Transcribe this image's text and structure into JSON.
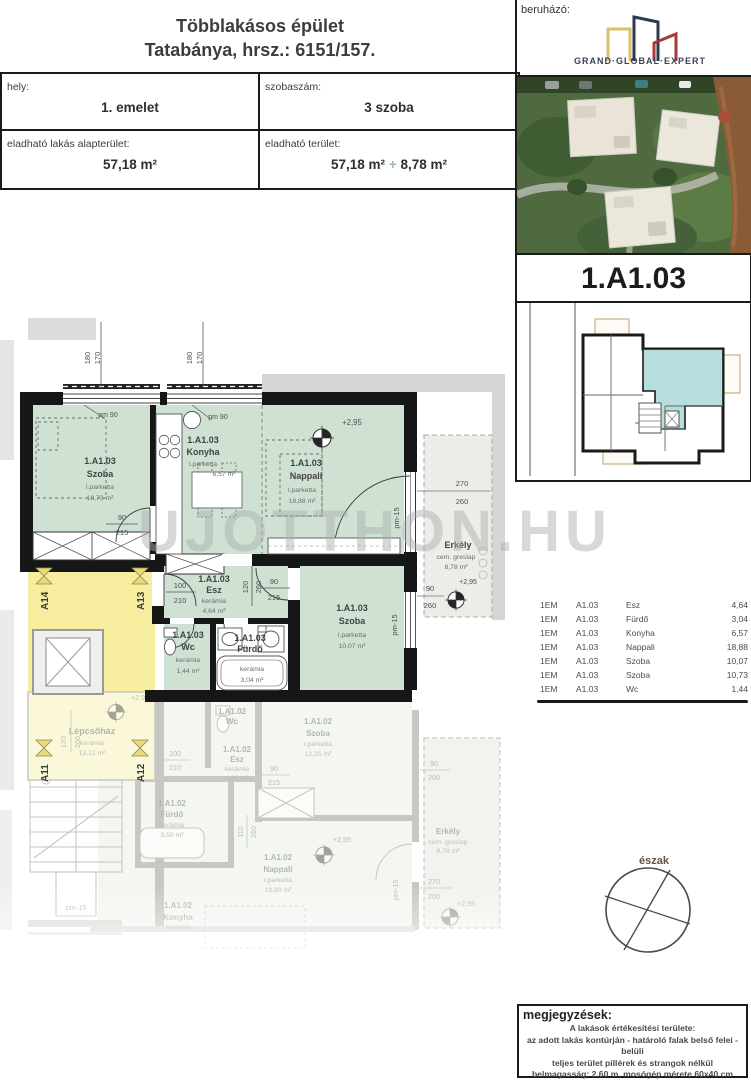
{
  "header": {
    "title1": "Többlakásos épület",
    "title2": "Tatabánya, hrsz.: 6151/157.",
    "hely_label": "hely:",
    "hely_value": "1. emelet",
    "szoba_label": "szobaszám:",
    "szoba_value": "3 szoba",
    "alap_label": "eladható lakás alapterület:",
    "alap_value": "57,18 m²",
    "ter_label": "eladható terület:",
    "ter_value": "57,18 m²",
    "ter_plus": "+",
    "ter_extra": "8,78 m²"
  },
  "developer": {
    "label": "beruházó:",
    "logo": "GRAND·GLOBAL·EXPERT"
  },
  "unit_id": "1.A1.03",
  "watermark": "UJOTTHON.HU",
  "room_table": {
    "rows": [
      {
        "floor": "1EM",
        "unit": "A1.03",
        "room": "Esz",
        "area": "4,64"
      },
      {
        "floor": "1EM",
        "unit": "A1.03",
        "room": "Fürdő",
        "area": "3,04"
      },
      {
        "floor": "1EM",
        "unit": "A1.03",
        "room": "Konyha",
        "area": "6,57"
      },
      {
        "floor": "1EM",
        "unit": "A1.03",
        "room": "Nappali",
        "area": "18,88"
      },
      {
        "floor": "1EM",
        "unit": "A1.03",
        "room": "Szoba",
        "area": "10,07"
      },
      {
        "floor": "1EM",
        "unit": "A1.03",
        "room": "Szoba",
        "area": "10,73"
      },
      {
        "floor": "1EM",
        "unit": "A1.03",
        "room": "Wc",
        "area": "1,44"
      }
    ]
  },
  "north": {
    "label": "észak"
  },
  "notes": {
    "title": "megjegyzések:",
    "line1": "A lakások értékesítési területe:",
    "line2": "az adott lakás kontúrján - határoló falak belső felei - belüli",
    "line3": "teljes terület pillérek és strangok nélkül",
    "line4": "belmagasság: 2,60 m, mosógép mérete 60x40 cm",
    "line5": "méretarány M1:100"
  },
  "plan": {
    "rooms": {
      "szoba1": {
        "unit": "1.A1.03",
        "name": "Szoba",
        "floor": "l.parketta",
        "area": "10,73 m²"
      },
      "konyha": {
        "unit": "1.A1.03",
        "name": "Konyha",
        "floor": "l.parketta",
        "area": "6,57 m²"
      },
      "nappali": {
        "unit": "1.A1.03",
        "name": "Nappali",
        "floor": "l.parketta",
        "area": "18,88 m²"
      },
      "esz": {
        "unit": "1.A1.03",
        "name": "Esz",
        "floor": "kerámia",
        "area": "4,64 m²"
      },
      "wc": {
        "unit": "1.A1.03",
        "name": "Wc",
        "floor": "kerámia",
        "area": "1,44 m²"
      },
      "furdo": {
        "unit": "1.A1.03",
        "name": "Fürdő",
        "floor": "kerámia",
        "area": "3,04 m²"
      },
      "szoba2": {
        "unit": "1.A1.03",
        "name": "Szoba",
        "floor": "l.parketta",
        "area": "10,07 m²"
      },
      "erkely": {
        "name": "Erkély",
        "floor": "cem. greslap",
        "area": "8,78 m²"
      },
      "lepcsohaz": {
        "name": "Lépcsőház",
        "floor": "kerámia",
        "area": "13,12 m²"
      }
    },
    "unit2": {
      "wc": {
        "unit": "1.A1.02",
        "name": "Wc"
      },
      "esz": {
        "unit": "1.A1.02",
        "name": "Esz",
        "floor": "kerámia",
        "area": "4,86 m²"
      },
      "szoba": {
        "unit": "1.A1.02",
        "name": "Szoba",
        "floor": "l.parketta",
        "area": "12,25 m²"
      },
      "furdo": {
        "unit": "1.A1.02",
        "name": "Fürdő",
        "floor": "kerámia",
        "area": "3,50 m²"
      },
      "nappali": {
        "unit": "1.A1.02",
        "name": "Nappali",
        "floor": "l.parketta",
        "area": "19,80 m²"
      },
      "konyha": {
        "unit": "1.A1.02",
        "name": "Konyha",
        "floor": "kerámia"
      },
      "erkely": {
        "name": "Erkély",
        "floor": "cem. greslap",
        "area": "8,78 m²"
      }
    },
    "apt": {
      "a14": "A14",
      "a13": "A13",
      "a11": "A11",
      "a12": "A12"
    },
    "dims": {
      "d180": "180",
      "d170": "170",
      "d90": "90",
      "d215": "215",
      "d100": "100",
      "d210": "210",
      "d120": "120",
      "d260": "260",
      "d270": "270",
      "d110": "110",
      "pm90": "pm 90",
      "pm15": "pm-15",
      "level": "+2,95"
    }
  }
}
